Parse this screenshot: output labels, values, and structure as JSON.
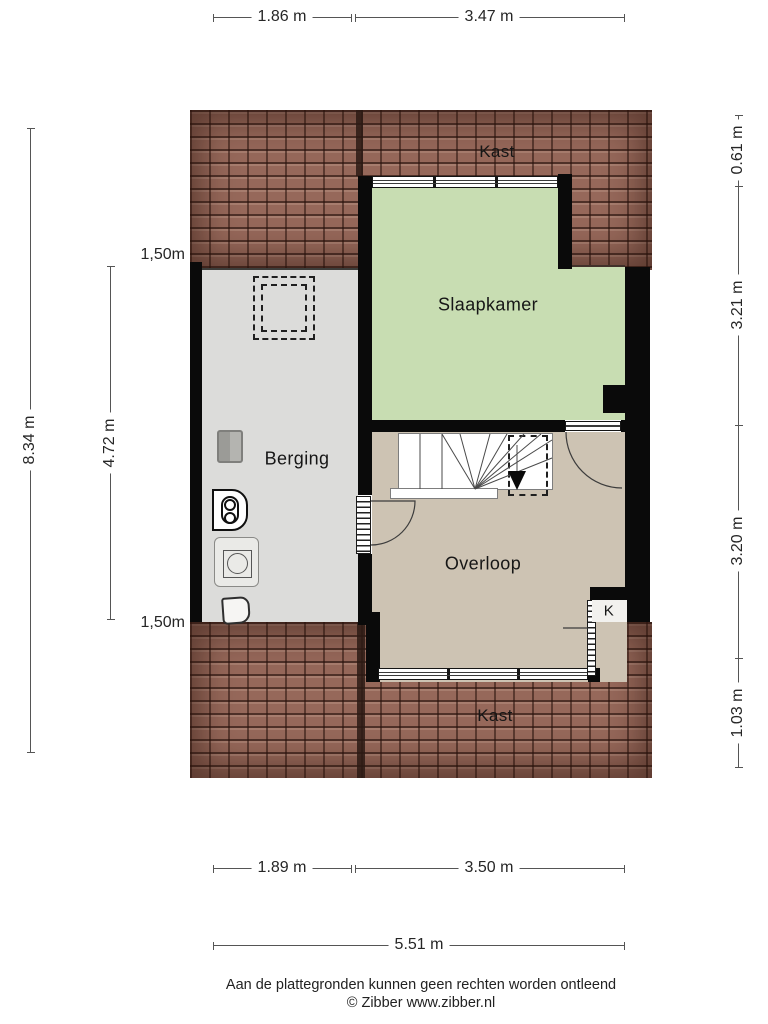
{
  "colors": {
    "roof_base": "#96685a",
    "wall": "#0a0a0a",
    "bedroom_green": "#c8ddb2",
    "landing_tan": "#cdc3b3",
    "storage_grey": "#dcdcda",
    "closet_white": "#f2f1ee",
    "dim_line": "#555555"
  },
  "rooms": {
    "kast_top": {
      "label": "Kast"
    },
    "slaapkamer": {
      "label": "Slaapkamer"
    },
    "berging": {
      "label": "Berging"
    },
    "overloop": {
      "label": "Overloop"
    },
    "k": {
      "label": "K"
    },
    "kast_bottom": {
      "label": "Kast"
    }
  },
  "dimensions": {
    "top_width_left": "1.86 m",
    "top_width_right": "3.47 m",
    "bottom_width_left": "1.89 m",
    "bottom_width_right": "3.50 m",
    "bottom_width_total": "5.51 m",
    "left_height_total": "8.34 m",
    "left_height_inner": "4.72 m",
    "headroom_top": "1,50m",
    "headroom_bottom": "1,50m",
    "right_height_1": "0.61 m",
    "right_height_2": "3.21 m",
    "right_height_3": "3.20 m",
    "right_height_4": "1.03 m"
  },
  "footer": {
    "disclaimer": "Aan de plattegronden kunnen geen rechten worden ontleend",
    "credit": "© Zibber www.zibber.nl"
  }
}
